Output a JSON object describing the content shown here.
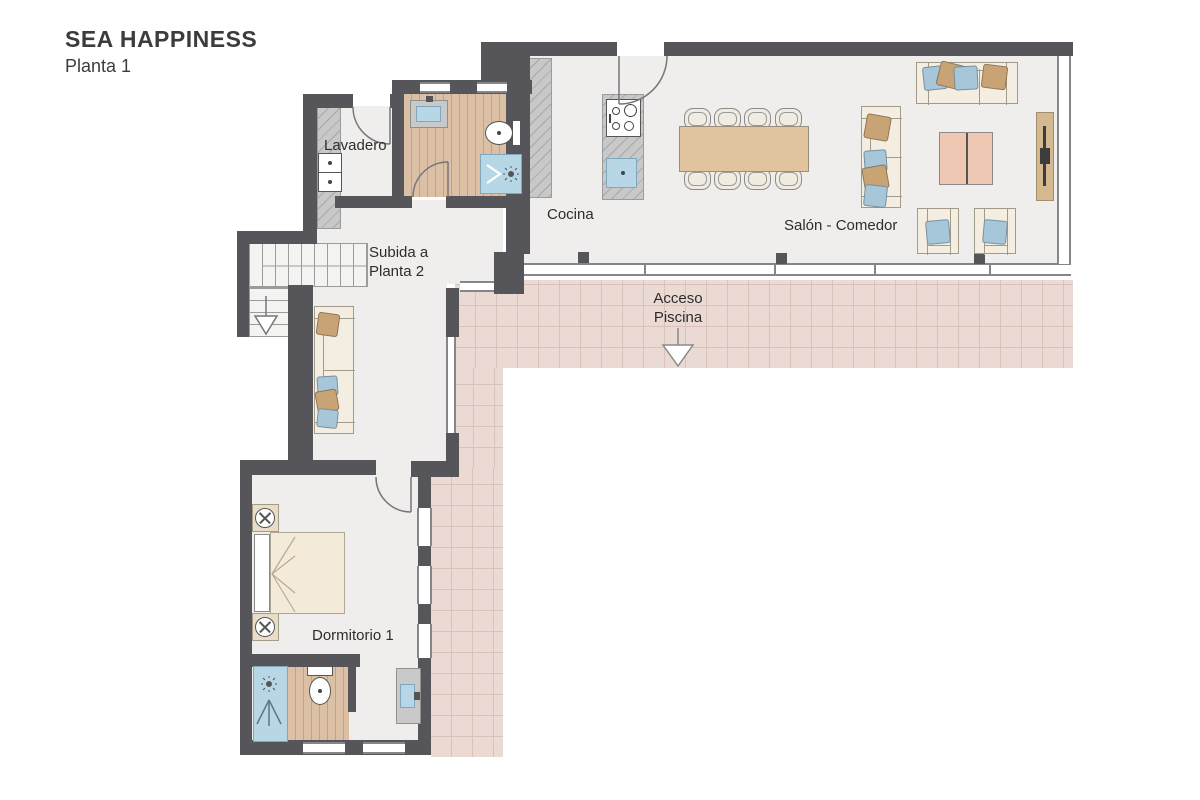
{
  "title": "SEA HAPPINESS",
  "subtitle": "Planta 1",
  "labels": {
    "laundry": "Lavadero",
    "kitchen": "Cocina",
    "living_dining": "Salón - Comedor",
    "stairs_line1": "Subida a",
    "stairs_line2": "Planta 2",
    "pool_line1": "Acceso",
    "pool_line2": "Piscina",
    "bedroom": "Dormitorio 1"
  },
  "colors": {
    "wall": "#56565a",
    "floor": "#efeeec",
    "wood": "#dcc0a6",
    "tile": "#ebdad3",
    "tile_grid": "#d9c2ba",
    "counter": "#c8c8c8",
    "glass_frame": "#85858a",
    "sofa_body": "#f4ede1",
    "sofa_border": "#a39b8a",
    "pillow_tan": "#c8a375",
    "pillow_blue": "#a6c6d9",
    "table_wood": "#e0c49e",
    "chair": "#f1ece2",
    "coffee": "#eec8b3",
    "console": "#d4b88f",
    "tv": "#3c3c3c",
    "fixture_blue": "#b7d6e6",
    "bed": "#f3ead9",
    "headboard": "#ffffff",
    "label": "#2d2d2d",
    "title": "#3c3c3c"
  }
}
